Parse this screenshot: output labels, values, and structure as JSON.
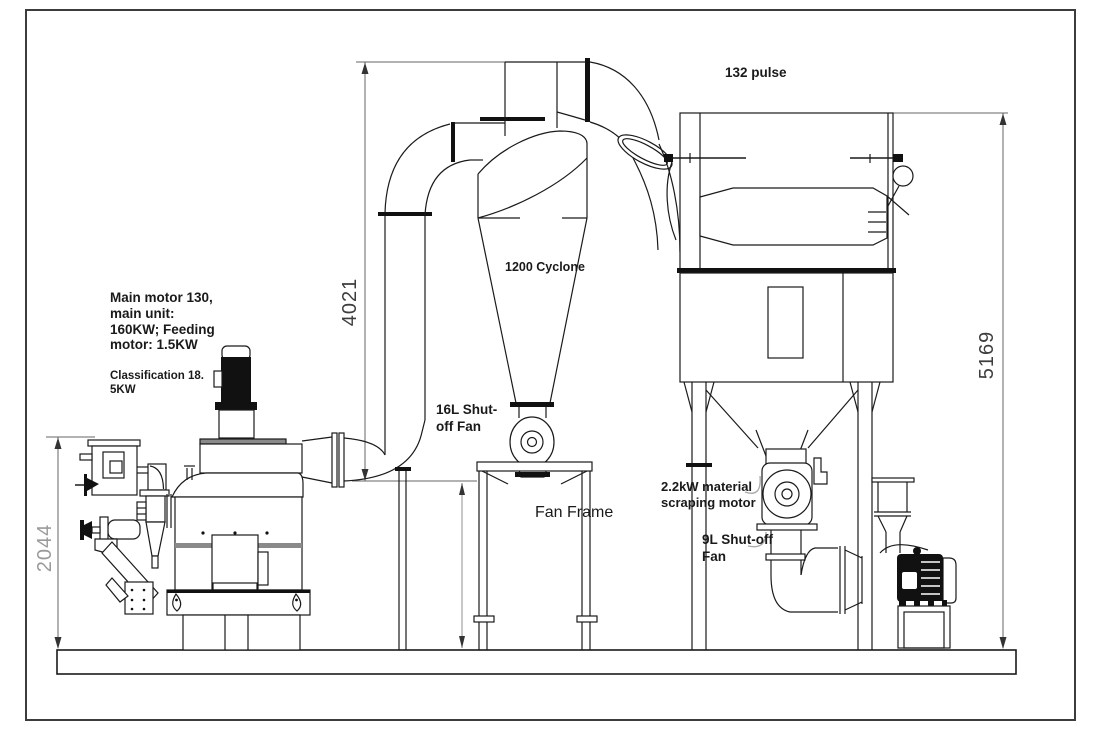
{
  "drawing": {
    "notes": {
      "main_motor": [
        "Main motor 130,",
        "main unit:",
        "160KW; Feeding",
        "motor: 1.5KW"
      ],
      "classification": [
        "Classification 18.",
        "5KW"
      ],
      "pulse": "132 pulse",
      "cyclone": "1200 Cyclone",
      "shutoff_fan_16l": [
        "16L Shut-",
        "off Fan"
      ],
      "fan_frame": "Fan Frame",
      "scraping_motor": [
        "2.2kW material",
        "scraping motor"
      ],
      "shutoff_fan_9l": [
        "9L Shut-off",
        "Fan"
      ]
    },
    "dimensions": {
      "height_left": "2044",
      "height_mid": "4021",
      "height_right": "5169"
    },
    "colors": {
      "line": "#1a1a1a",
      "dim_line": "#666666",
      "dim_text": "#3d3d3d",
      "dim_text_light": "#9a9a9a",
      "background": "#ffffff"
    }
  }
}
